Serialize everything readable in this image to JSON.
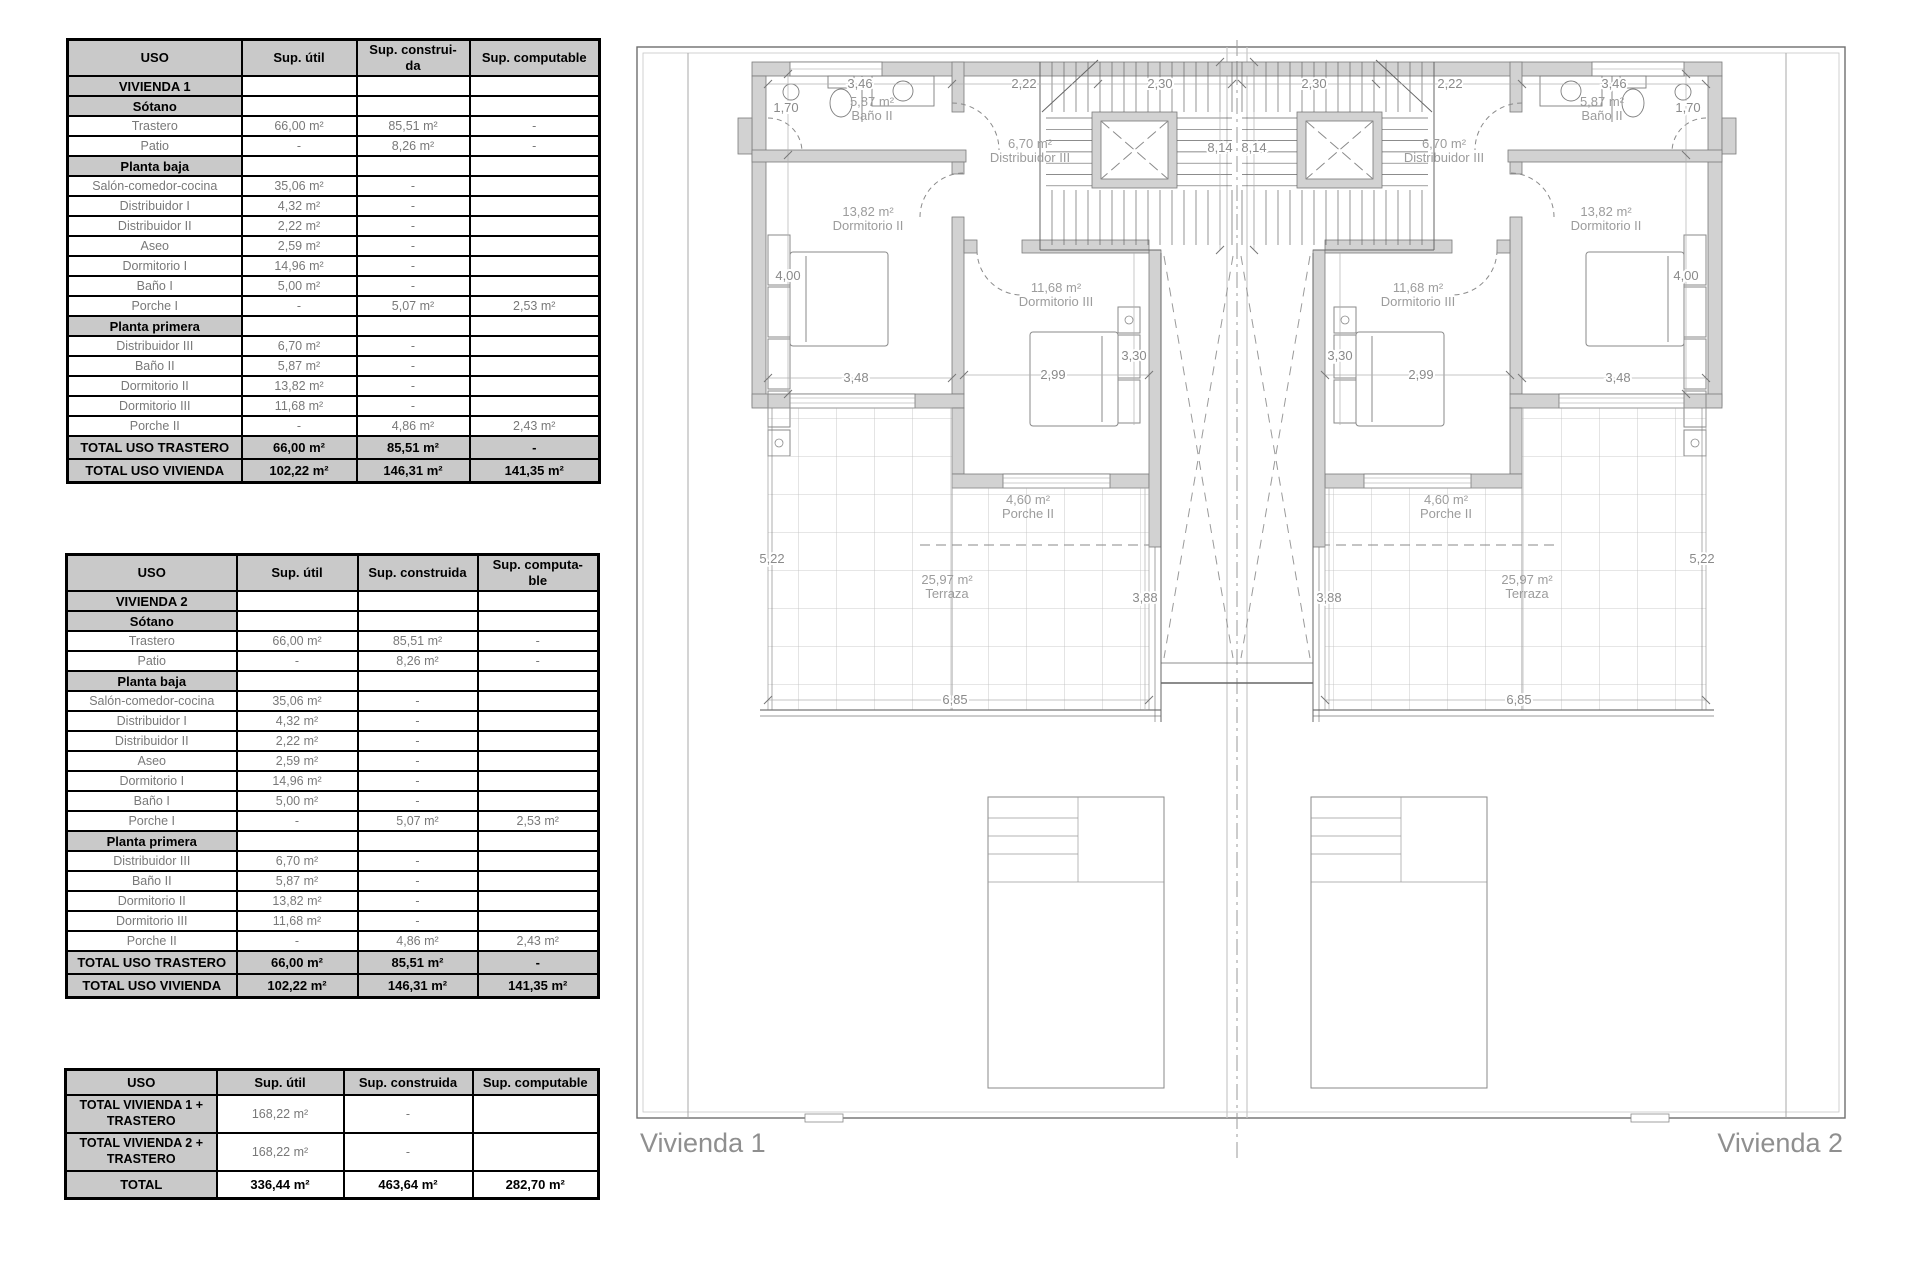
{
  "tables": [
    {
      "headers": [
        "USO",
        "Sup. útil",
        "Sup. construi-\nda",
        "Sup. computable"
      ],
      "rows": [
        {
          "type": "section",
          "label": "VIVIENDA 1",
          "values": [
            "",
            "",
            ""
          ]
        },
        {
          "type": "section",
          "label": "Sótano",
          "values": [
            "",
            "",
            ""
          ]
        },
        {
          "type": "data",
          "label": "Trastero",
          "values": [
            "66,00 m²",
            "85,51 m²",
            "-"
          ]
        },
        {
          "type": "data",
          "label": "Patio",
          "values": [
            "-",
            "8,26 m²",
            "-"
          ]
        },
        {
          "type": "section",
          "label": "Planta baja",
          "values": [
            "",
            "",
            ""
          ]
        },
        {
          "type": "data",
          "label": "Salón-comedor-cocina",
          "values": [
            "35,06 m²",
            "-",
            ""
          ]
        },
        {
          "type": "data",
          "label": "Distribuidor I",
          "values": [
            "4,32 m²",
            "-",
            ""
          ]
        },
        {
          "type": "data",
          "label": "Distribuidor II",
          "values": [
            "2,22 m²",
            "-",
            ""
          ]
        },
        {
          "type": "data",
          "label": "Aseo",
          "values": [
            "2,59 m²",
            "-",
            ""
          ]
        },
        {
          "type": "data",
          "label": "Dormitorio I",
          "values": [
            "14,96 m²",
            "-",
            ""
          ]
        },
        {
          "type": "data",
          "label": "Baño I",
          "values": [
            "5,00 m²",
            "-",
            ""
          ]
        },
        {
          "type": "data",
          "label": "Porche I",
          "values": [
            "-",
            "5,07 m²",
            "2,53 m²"
          ]
        },
        {
          "type": "section",
          "label": "Planta primera",
          "values": [
            "",
            "",
            ""
          ]
        },
        {
          "type": "data",
          "label": "Distribuidor III",
          "values": [
            "6,70 m²",
            "-",
            ""
          ]
        },
        {
          "type": "data",
          "label": "Baño II",
          "values": [
            "5,87 m²",
            "-",
            ""
          ]
        },
        {
          "type": "data",
          "label": "Dormitorio II",
          "values": [
            "13,82 m²",
            "-",
            ""
          ]
        },
        {
          "type": "data",
          "label": "Dormitorio III",
          "values": [
            "11,68 m²",
            "-",
            ""
          ]
        },
        {
          "type": "data",
          "label": "Porche II",
          "values": [
            "-",
            "4,86 m²",
            "2,43 m²"
          ]
        },
        {
          "type": "total",
          "label": "TOTAL USO TRASTERO",
          "values": [
            "66,00 m²",
            "85,51 m²",
            "-"
          ]
        },
        {
          "type": "total",
          "label": "TOTAL USO VIVIENDA",
          "values": [
            "102,22 m²",
            "146,31 m²",
            "141,35 m²"
          ]
        }
      ]
    },
    {
      "headers": [
        "USO",
        "Sup. útil",
        "Sup. construida",
        "Sup. computa-\nble"
      ],
      "rows": [
        {
          "type": "section",
          "label": "VIVIENDA 2",
          "values": [
            "",
            "",
            ""
          ]
        },
        {
          "type": "section",
          "label": "Sótano",
          "values": [
            "",
            "",
            ""
          ]
        },
        {
          "type": "data",
          "label": "Trastero",
          "values": [
            "66,00 m²",
            "85,51 m²",
            "-"
          ]
        },
        {
          "type": "data",
          "label": "Patio",
          "values": [
            "-",
            "8,26 m²",
            "-"
          ]
        },
        {
          "type": "section",
          "label": "Planta baja",
          "values": [
            "",
            "",
            ""
          ]
        },
        {
          "type": "data",
          "label": "Salón-comedor-cocina",
          "values": [
            "35,06 m²",
            "-",
            ""
          ]
        },
        {
          "type": "data",
          "label": "Distribuidor I",
          "values": [
            "4,32 m²",
            "-",
            ""
          ]
        },
        {
          "type": "data",
          "label": "Distribuidor II",
          "values": [
            "2,22 m²",
            "-",
            ""
          ]
        },
        {
          "type": "data",
          "label": "Aseo",
          "values": [
            "2,59 m²",
            "-",
            ""
          ]
        },
        {
          "type": "data",
          "label": "Dormitorio I",
          "values": [
            "14,96 m²",
            "-",
            ""
          ]
        },
        {
          "type": "data",
          "label": "Baño I",
          "values": [
            "5,00 m²",
            "-",
            ""
          ]
        },
        {
          "type": "data",
          "label": "Porche I",
          "values": [
            "-",
            "5,07 m²",
            "2,53 m²"
          ]
        },
        {
          "type": "section",
          "label": "Planta primera",
          "values": [
            "",
            "",
            ""
          ]
        },
        {
          "type": "data",
          "label": "Distribuidor III",
          "values": [
            "6,70 m²",
            "-",
            ""
          ]
        },
        {
          "type": "data",
          "label": "Baño II",
          "values": [
            "5,87 m²",
            "-",
            ""
          ]
        },
        {
          "type": "data",
          "label": "Dormitorio II",
          "values": [
            "13,82 m²",
            "-",
            ""
          ]
        },
        {
          "type": "data",
          "label": "Dormitorio III",
          "values": [
            "11,68 m²",
            "-",
            ""
          ]
        },
        {
          "type": "data",
          "label": "Porche II",
          "values": [
            "-",
            "4,86 m²",
            "2,43 m²"
          ]
        },
        {
          "type": "total",
          "label": "TOTAL USO TRASTERO",
          "values": [
            "66,00 m²",
            "85,51 m²",
            "-"
          ]
        },
        {
          "type": "total",
          "label": "TOTAL USO VIVIENDA",
          "values": [
            "102,22 m²",
            "146,31 m²",
            "141,35 m²"
          ]
        }
      ]
    },
    {
      "headers": [
        "USO",
        "Sup. útil",
        "Sup. construida",
        "Sup. computable"
      ],
      "rows": [
        {
          "type": "t3row",
          "label": "TOTAL VIVIENDA 1 +\nTRASTERO",
          "values": [
            "168,22 m²",
            "-",
            ""
          ]
        },
        {
          "type": "t3row",
          "label": "TOTAL VIVIENDA 2 +\nTRASTERO",
          "values": [
            "168,22 m²",
            "-",
            ""
          ]
        },
        {
          "type": "t3total",
          "label": "TOTAL",
          "values": [
            "336,44 m²",
            "463,64 m²",
            "282,70 m²"
          ]
        }
      ]
    }
  ],
  "plan": {
    "captions": [
      {
        "x": 640,
        "y": 1152,
        "anchor": "start",
        "text": "Vivienda 1"
      },
      {
        "x": 1843,
        "y": 1152,
        "anchor": "end",
        "text": "Vivienda 2"
      }
    ],
    "room_labels": [
      {
        "x": 872,
        "y": 106,
        "lines": [
          "5,87 m²",
          "Baño II"
        ]
      },
      {
        "x": 1030,
        "y": 148,
        "lines": [
          "6,70 m²",
          "Distribuidor III"
        ]
      },
      {
        "x": 868,
        "y": 216,
        "lines": [
          "13,82 m²",
          "Dormitorio II"
        ]
      },
      {
        "x": 1056,
        "y": 292,
        "lines": [
          "11,68 m²",
          "Dormitorio III"
        ]
      },
      {
        "x": 1028,
        "y": 504,
        "lines": [
          "4,60 m²",
          "Porche II"
        ]
      },
      {
        "x": 947,
        "y": 584,
        "lines": [
          "25,97 m²",
          "Terraza"
        ]
      },
      {
        "x": 1602,
        "y": 106,
        "lines": [
          "5,87 m²",
          "Baño II"
        ]
      },
      {
        "x": 1444,
        "y": 148,
        "lines": [
          "6,70 m²",
          "Distribuidor III"
        ]
      },
      {
        "x": 1606,
        "y": 216,
        "lines": [
          "13,82 m²",
          "Dormitorio II"
        ]
      },
      {
        "x": 1418,
        "y": 292,
        "lines": [
          "11,68 m²",
          "Dormitorio III"
        ]
      },
      {
        "x": 1446,
        "y": 504,
        "lines": [
          "4,60 m²",
          "Porche II"
        ]
      },
      {
        "x": 1527,
        "y": 584,
        "lines": [
          "25,97 m²",
          "Terraza"
        ]
      }
    ],
    "dimensions": [
      {
        "x": 860,
        "y": 88,
        "text": "3,46"
      },
      {
        "x": 1024,
        "y": 88,
        "text": "2,22"
      },
      {
        "x": 1160,
        "y": 88,
        "text": "2,30"
      },
      {
        "x": 786,
        "y": 112,
        "text": "1,70"
      },
      {
        "x": 1220,
        "y": 152,
        "text": "8,14"
      },
      {
        "x": 788,
        "y": 280,
        "text": "4,00"
      },
      {
        "x": 856,
        "y": 382,
        "text": "3,48"
      },
      {
        "x": 1053,
        "y": 379,
        "text": "2,99"
      },
      {
        "x": 1134,
        "y": 360,
        "text": "3,30"
      },
      {
        "x": 772,
        "y": 563,
        "text": "5,22"
      },
      {
        "x": 1145,
        "y": 602,
        "text": "3,88"
      },
      {
        "x": 955,
        "y": 704,
        "text": "6,85"
      },
      {
        "x": 1614,
        "y": 88,
        "text": "3,46"
      },
      {
        "x": 1450,
        "y": 88,
        "text": "2,22"
      },
      {
        "x": 1314,
        "y": 88,
        "text": "2,30"
      },
      {
        "x": 1688,
        "y": 112,
        "text": "1,70"
      },
      {
        "x": 1254,
        "y": 152,
        "text": "8,14"
      },
      {
        "x": 1686,
        "y": 280,
        "text": "4,00"
      },
      {
        "x": 1618,
        "y": 382,
        "text": "3,48"
      },
      {
        "x": 1421,
        "y": 379,
        "text": "2,99"
      },
      {
        "x": 1340,
        "y": 360,
        "text": "3,30"
      },
      {
        "x": 1702,
        "y": 563,
        "text": "5,22"
      },
      {
        "x": 1329,
        "y": 602,
        "text": "3,88"
      },
      {
        "x": 1519,
        "y": 704,
        "text": "6,85"
      }
    ]
  }
}
